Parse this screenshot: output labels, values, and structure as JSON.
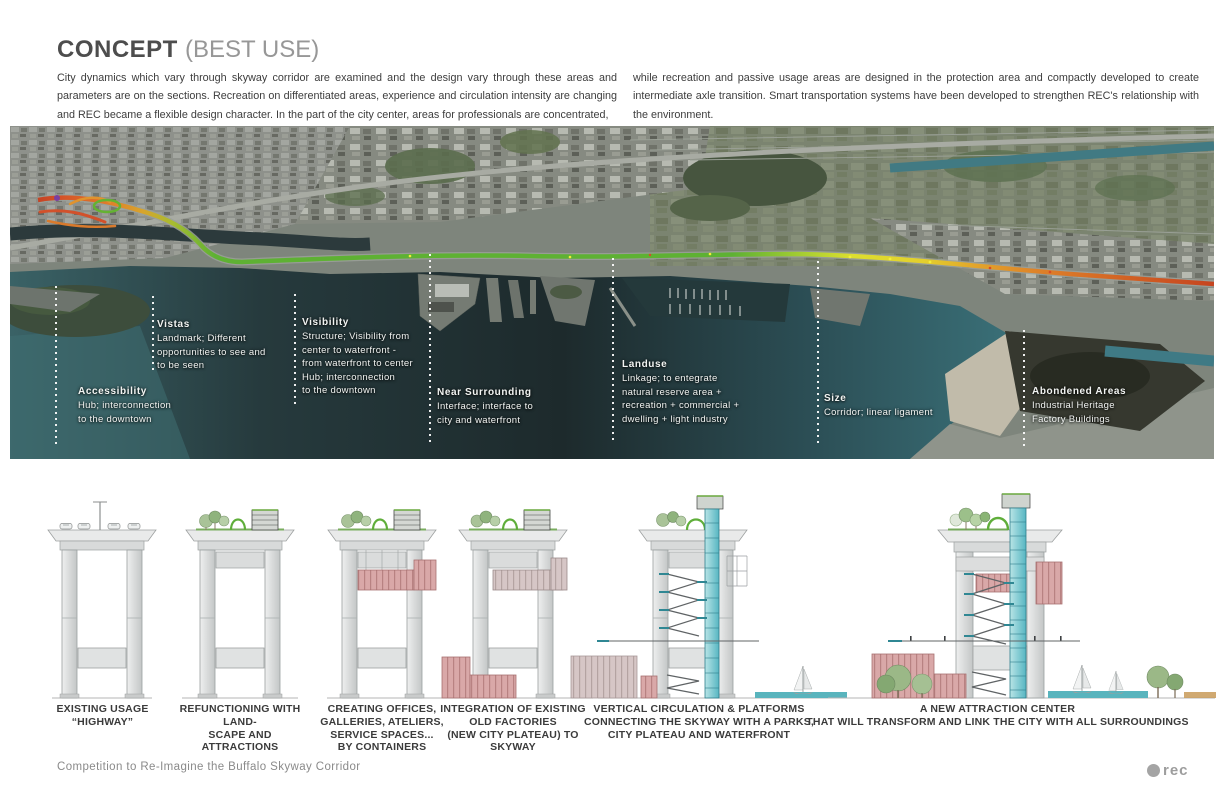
{
  "header": {
    "title": "CONCEPT",
    "subtitle": "(BEST USE)",
    "paragraph_left": "City dynamics which vary through skyway corridor are examined and the design vary through these areas and parameters are on the sections. Recreation on differentiated areas, experience and circulation intensity are changing and REC became a flexible design character. In the part of the city center, areas for professionals are concentrated,",
    "paragraph_right": "while recreation and passive usage areas are designed in the protection area and compactly developed to create intermediate axle transition. Smart transportation systems have been developed to strengthen REC's relationship with the environment."
  },
  "map": {
    "annotations": [
      {
        "title": "Accessibility",
        "lines": [
          "Hub; interconnection",
          "to the downtown"
        ]
      },
      {
        "title": "Vistas",
        "lines": [
          "Landmark; Different",
          "opportunities to see and",
          "to be seen"
        ]
      },
      {
        "title": "Visibility",
        "lines": [
          "Structure; Visibility from",
          "center to waterfront -",
          "from waterfront to center",
          "Hub; interconnection",
          "to the downtown"
        ]
      },
      {
        "title": "Near Surrounding",
        "lines": [
          "Interface; interface to",
          "city and waterfront"
        ]
      },
      {
        "title": "Landuse",
        "lines": [
          "Linkage; to entegrate",
          "natural reserve area +",
          "recreation + commercial +",
          "dwelling + light industry"
        ]
      },
      {
        "title": "Size",
        "lines": [
          "Corridor; linear ligament"
        ]
      },
      {
        "title": "Abondened Areas",
        "lines": [
          "Industrial Heritage",
          "Factory Buildings"
        ]
      }
    ]
  },
  "sections": {
    "captions": [
      {
        "lines": [
          "EXISTING USAGE",
          "“HIGHWAY”"
        ]
      },
      {
        "lines": [
          "REFUNCTIONING WITH LAND-",
          "SCAPE AND",
          "ATTRACTIONS"
        ]
      },
      {
        "lines": [
          "CREATING OFFICES,",
          "GALLERIES, ATELIERS,",
          "SERVICE SPACES...",
          "BY CONTAINERS"
        ]
      },
      {
        "lines": [
          "INTEGRATION OF EXISTING",
          "OLD FACTORIES",
          "(NEW CITY PLATEAU) TO SKYWAY"
        ]
      },
      {
        "lines": [
          "VERTICAL CIRCULATION & PLATFORMS",
          "CONNECTING THE SKYWAY WITH A PARKS,",
          "CITY PLATEAU AND WATERFRONT"
        ]
      },
      {
        "lines": [
          "A NEW ATTRACTION CENTER",
          "THAT WILL TRANSFORM AND LINK THE CITY WITH ALL SURROUNDINGS"
        ]
      }
    ]
  },
  "footer": {
    "competition": "Competition to  Re-Imagine the Buffalo Skyway Corridor",
    "logo_text": "rec"
  },
  "colors": {
    "route_red": "#c43b23",
    "route_orange": "#e2802b",
    "route_yellow": "#e3cf2d",
    "route_green": "#5eb133",
    "water_dark": "#1d2a2c",
    "water_teal": "#3a7078",
    "container_red": "#d9a8a8",
    "elevator_teal": "#57b6c2"
  }
}
